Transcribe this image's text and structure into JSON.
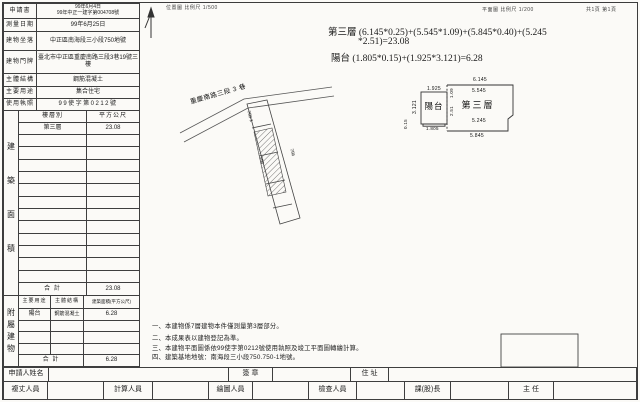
{
  "header": {
    "location_scale": "位置圖 比例尺 1/500",
    "plan_scale": "平面圖 比例尺 1/200",
    "page_info": "共1頁 第1頁"
  },
  "info_table": {
    "rows": [
      {
        "label": "申請書",
        "value": "99年6月4日",
        "value2": "99年中正一建字第004708號"
      },
      {
        "label": "測量日期",
        "value": "99年6月25日"
      },
      {
        "label": "建物坐落",
        "value": "中正區南海段三小段750地號"
      },
      {
        "label": "建物門牌",
        "value": "臺北市中正區重慶南路三段3巷19號三樓"
      },
      {
        "label": "主體結構",
        "value": "鋼筋混凝土"
      },
      {
        "label": "主要用途",
        "value": "集合住宅"
      },
      {
        "label": "使用執照",
        "value": "99使字第0212號"
      }
    ]
  },
  "area_table": {
    "section_label": "建築面積",
    "col_floor": "樓層別",
    "col_sqm": "平方公尺",
    "rows": [
      {
        "floor": "第三層",
        "sqm": "23.08"
      }
    ],
    "total_label": "合  計",
    "total": "23.08"
  },
  "annex_table": {
    "section_label": "附屬建物",
    "col_use": "主要用途",
    "col_structure": "主體結構",
    "col_area": "建築面積(平方公尺)",
    "rows": [
      {
        "use": "陽台",
        "structure": "鋼筋混凝土",
        "area": "6.28"
      }
    ],
    "total_label": "合  計",
    "total": "6.28"
  },
  "formulas": {
    "line1": "第三層 (6.145*0.25)+(5.545*1.09)+(5.845*0.40)+(5.245",
    "line2": "*2.51)=23.08",
    "line3": "陽台 (1.805*0.15)+(1.925*3.121)=6.28"
  },
  "site_plan": {
    "street": "重慶南路三段 3 巷",
    "lot1": "750-1",
    "lot2": "750",
    "lot3": "756"
  },
  "floor_plan": {
    "room": "第三層",
    "balcony": "陽台",
    "dims": {
      "top": "6.145",
      "inner_top": "5.545",
      "inner_bottom": "5.245",
      "bottom": "5.845",
      "balcony_top": "1.925",
      "balcony_left": "3.121",
      "balcony_bottom": "1.805",
      "strip": "0.15",
      "seg1": "1.09",
      "seg2": "2.51"
    }
  },
  "notes": [
    "一、本建物係7層建物本件僅測量第3層部分。",
    "二、本成果表以建物登記為準。",
    "三、本建物平面圖係依99使字第0212號使用執照及竣工平面圖轉繪計算。",
    "四、建築基地地號：南海段三小段750.750-1地號。"
  ],
  "footer": {
    "applicant_label": "申請人姓名",
    "seal_label": "簽  章",
    "address_label": "住  址",
    "staff": [
      {
        "label": "複丈人員"
      },
      {
        "label": "計算人員"
      },
      {
        "label": "繪圖人員"
      },
      {
        "label": "檢查人員"
      },
      {
        "label": "課(股)長"
      },
      {
        "label": "主  任"
      }
    ]
  }
}
